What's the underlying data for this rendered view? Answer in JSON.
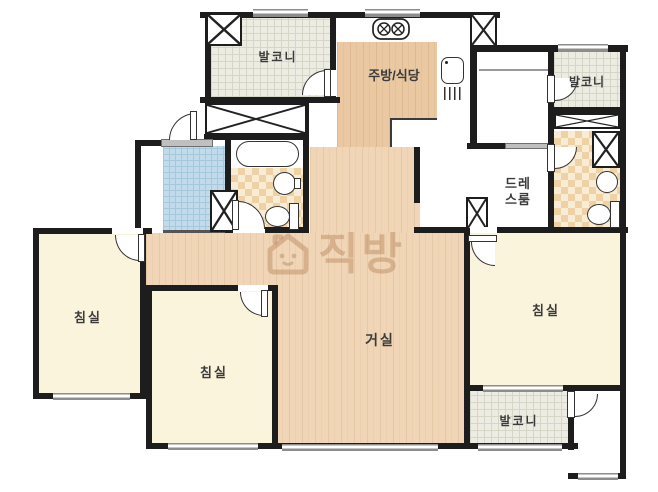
{
  "plan": {
    "title": "apartment-floor-plan",
    "rooms": {
      "balcony_top_left": "발코니",
      "kitchen_dining": "주방/식당",
      "balcony_top_right": "발코니",
      "dress_room_line1": "드레",
      "dress_room_line2": "스룸",
      "bedroom_left": "침실",
      "bedroom_middle": "침실",
      "bedroom_right": "침실",
      "living_room": "거실",
      "balcony_bottom": "발코니"
    },
    "watermark": {
      "text": "직방"
    },
    "colors": {
      "wall": "#1d1d1d",
      "wood_living": "#f0d6b6",
      "wood_kitchen": "#eac9a2",
      "bedroom_cream": "#fbf4dd",
      "balcony_grid": "#ececE3",
      "entry_tile": "#c2dbea",
      "bath_checker": "#eed2a6",
      "watermark": "rgba(183,134,92,0.45)"
    }
  }
}
